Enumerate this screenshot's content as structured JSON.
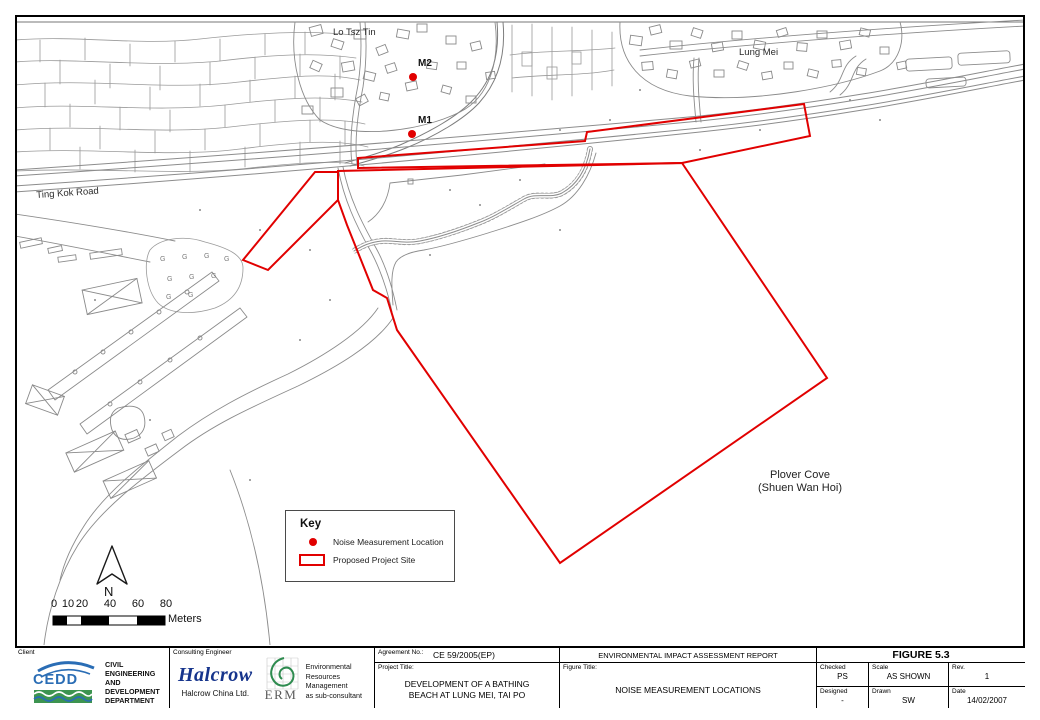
{
  "map": {
    "labels": {
      "lo_tsz_tin": "Lo Tsz Tin",
      "lung_mei": "Lung Mei",
      "m1": "M1",
      "m2": "M2",
      "ting_kok_road": "Ting Kok Road",
      "plover_cove_line1": "Plover Cove",
      "plover_cove_line2": "(Shuen Wan Hoi)",
      "north": "N",
      "grass_symbol": "G"
    },
    "scale_bar": {
      "ticks": [
        "0",
        "10",
        "20",
        "40",
        "60",
        "80"
      ],
      "unit": "Meters"
    },
    "key": {
      "title": "Key",
      "items": [
        {
          "symbol": "red-dot",
          "label": "Noise Measurement Location"
        },
        {
          "symbol": "red-rectangle-outline",
          "label": "Proposed Project Site"
        }
      ]
    },
    "colors": {
      "site_outline": "#e10000",
      "noise_dot": "#e10000",
      "map_line": "#8c8c8c"
    }
  },
  "title_block": {
    "client_label": "Client",
    "cedd_logo_text": "CEDD",
    "client_name_line1": "CIVIL ENGINEERING",
    "client_name_line2": "AND DEVELOPMENT",
    "client_name_line3": "DEPARTMENT",
    "consulting_engineer_label": "Consulting Engineer",
    "halcrow_logo_text": "Halcrow",
    "halcrow_company": "Halcrow China Ltd.",
    "erm_logo_text": "ERM",
    "erm_line1": "Environmental",
    "erm_line2": "Resources",
    "erm_line3": "Management",
    "erm_line4": "as sub-consultant",
    "agreement_label": "Agreement No.:",
    "agreement_value": "CE 59/2005(EP)",
    "project_title_label": "Project Title:",
    "project_title_line1": "DEVELOPMENT OF A BATHING",
    "project_title_line2": "BEACH AT LUNG MEI, TAI PO",
    "report_title": "ENVIRONMENTAL IMPACT ASSESSMENT REPORT",
    "figure_number": "FIGURE 5.3",
    "figure_title_label": "Figure Title:",
    "figure_title": "NOISE MEASUREMENT LOCATIONS",
    "checked_label": "Checked",
    "checked_value": "PS",
    "scale_label": "Scale",
    "scale_value": "AS SHOWN",
    "rev_label": "Rev.",
    "rev_value": "1",
    "designed_label": "Designed",
    "designed_value": "-",
    "drawn_label": "Drawn",
    "drawn_value": "SW",
    "date_label": "Date",
    "date_value": "14/02/2007"
  }
}
